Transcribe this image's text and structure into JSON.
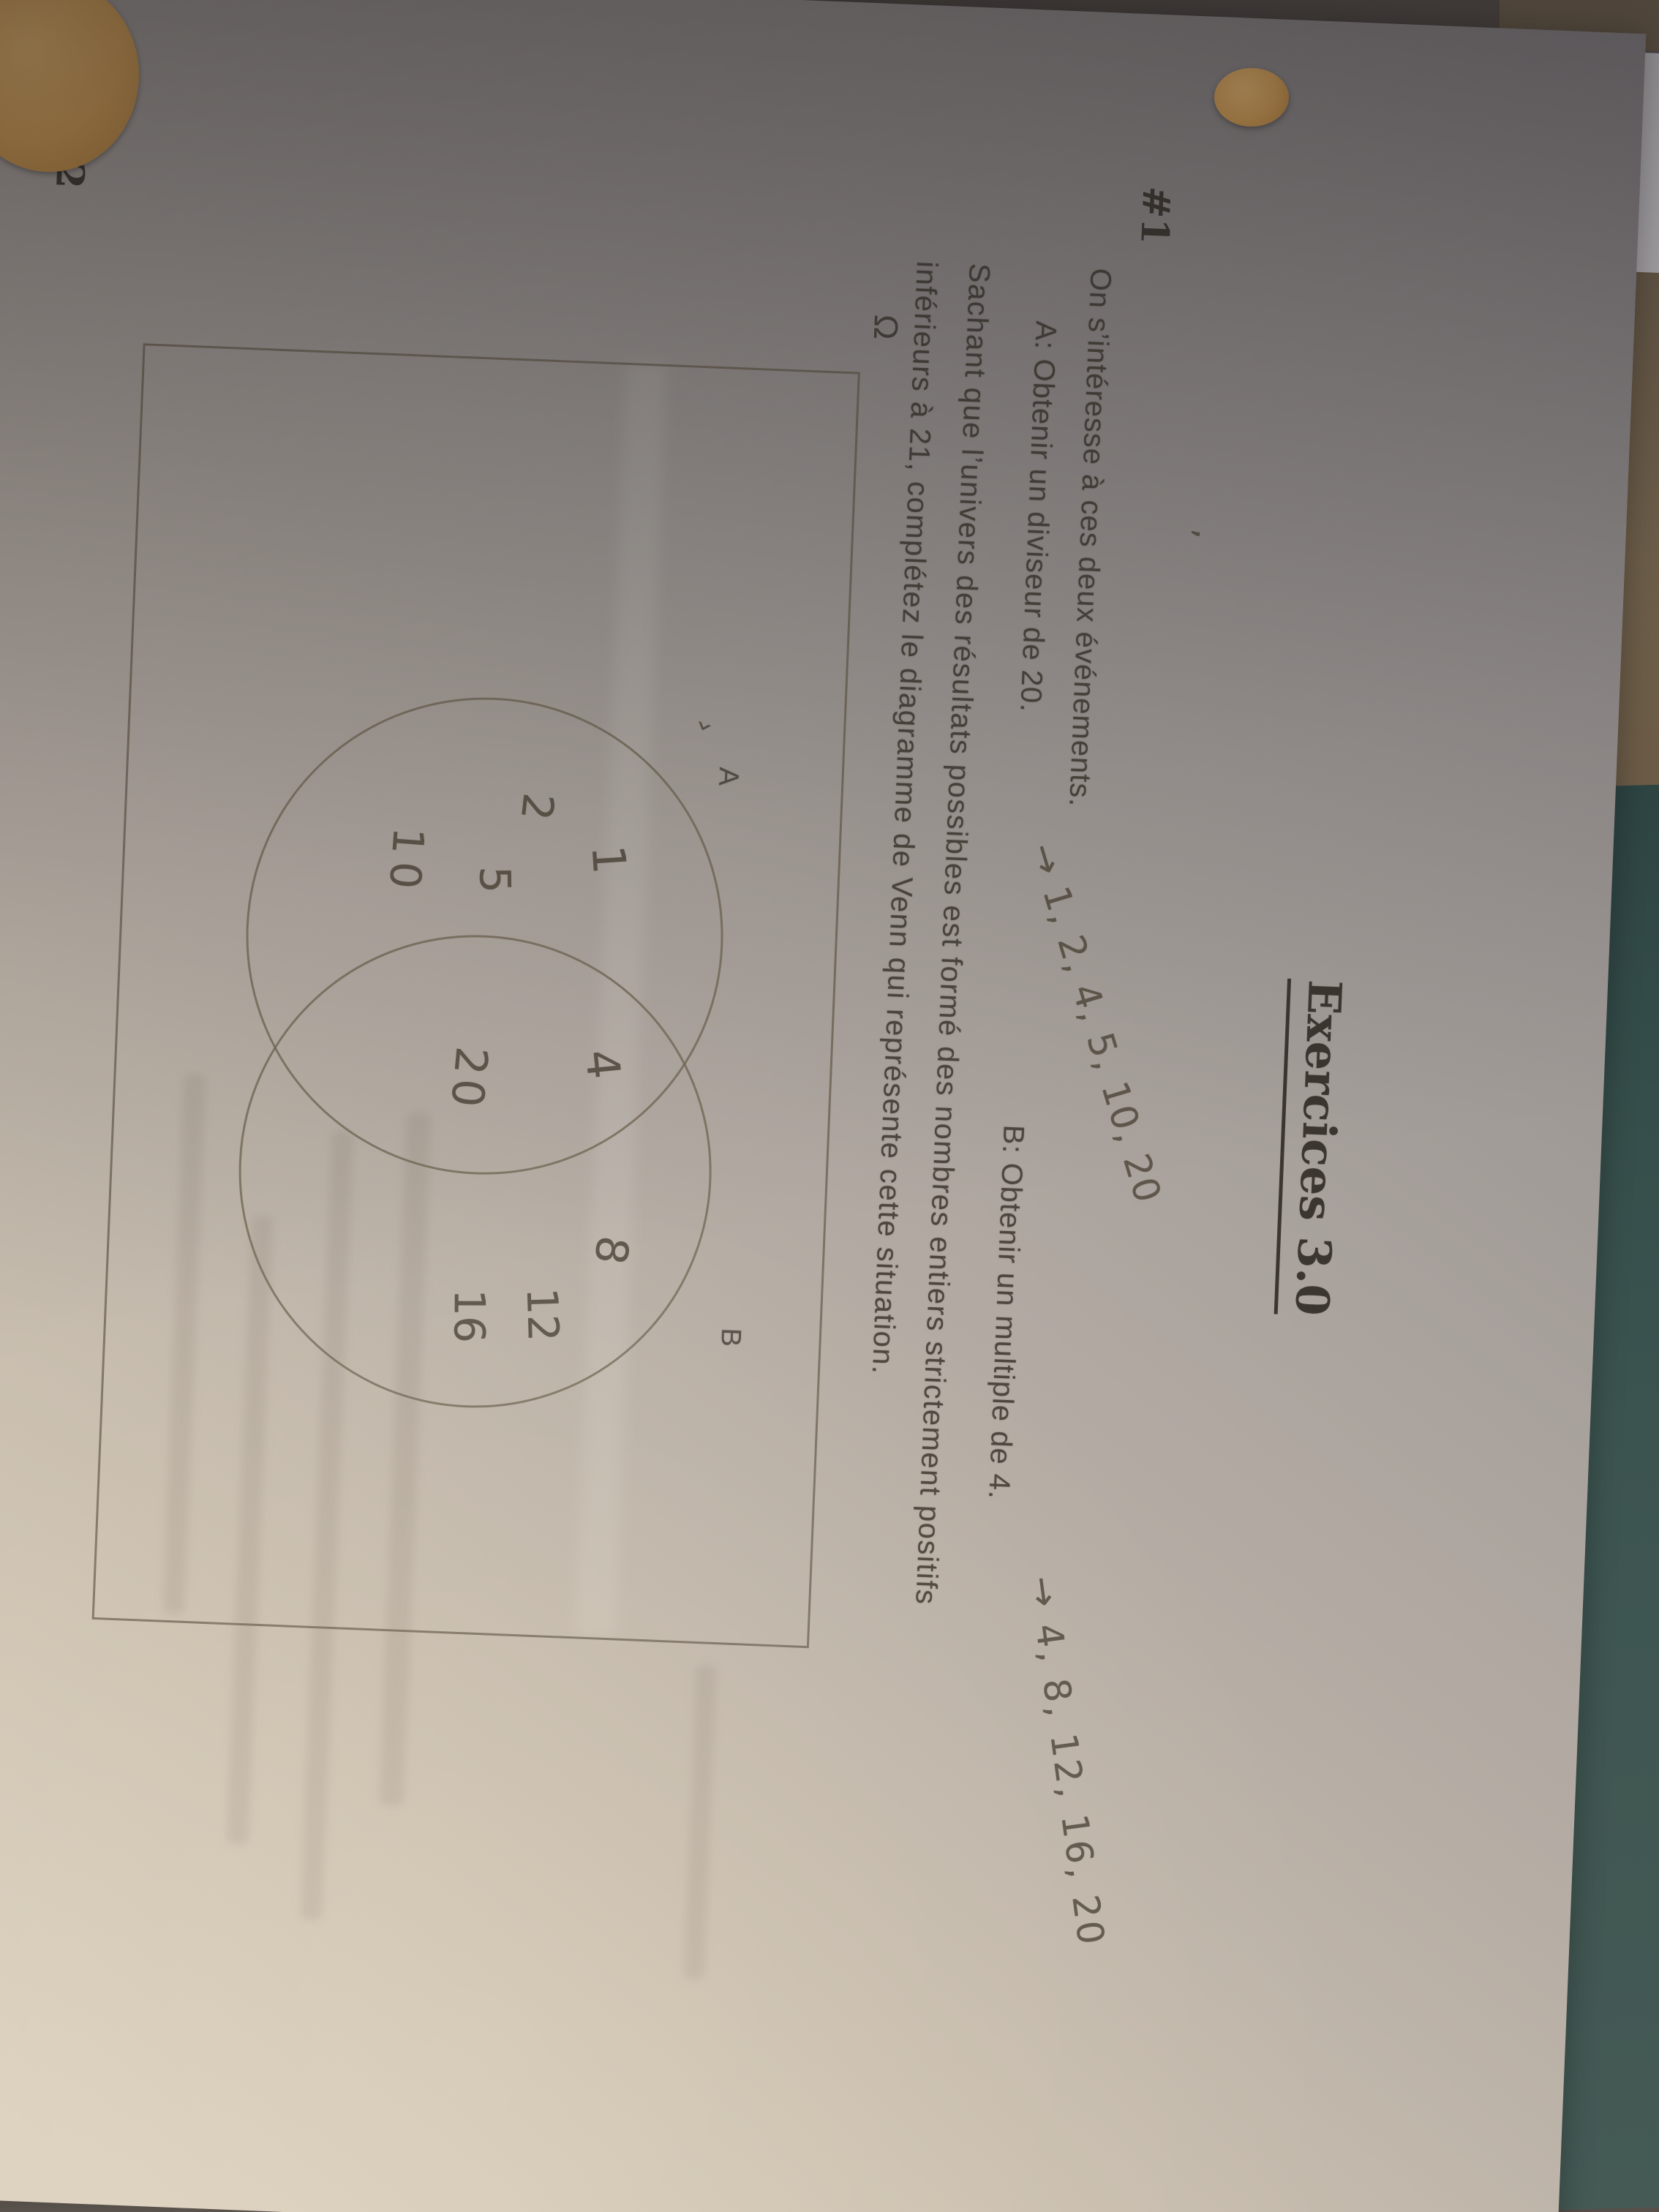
{
  "document": {
    "title": "Exercices 3.0",
    "exercise_1": {
      "number_label": "#1",
      "intro": "On s’intéresse à ces deux événements.",
      "event_a": "A: Obtenir un diviseur de 20.",
      "event_a_handwritten": "→ 1, 2, 4, 5, 10, 20",
      "event_b": "B: Obtenir un multiple de 4.",
      "event_b_handwritten": "→ 4, 8, 12, 16, 20",
      "instruction_line_1": "Sachant que l’univers des résultats possibles est formé des nombres entiers strictement positifs",
      "instruction_line_2": "inférieurs à 21, complétez le diagramme de Venn qui représente cette situation.",
      "venn_diagram": {
        "universe_label": "Ω",
        "circle_a_label": "A",
        "circle_b_label": "B",
        "region_a_only": [
          "1",
          "2",
          "5",
          "10"
        ],
        "region_intersection": [
          "4",
          "20"
        ],
        "region_b_only": [
          "8",
          "12",
          "16"
        ]
      }
    },
    "exercise_2": {
      "number_label": "#2"
    },
    "stray_marks": {
      "comma": ",",
      "tick": "›"
    }
  },
  "colors": {
    "paper_light": "#dcd1bf",
    "paper_shadow": "#7f7b7e",
    "ink_print": "#4c463e",
    "pencil": "#5f574b",
    "table_teal": "#3c5450",
    "table_tan": "#7b6a52",
    "binder_ring_orange": "#d29e55",
    "sheet_behind": "#c6c3c6"
  }
}
